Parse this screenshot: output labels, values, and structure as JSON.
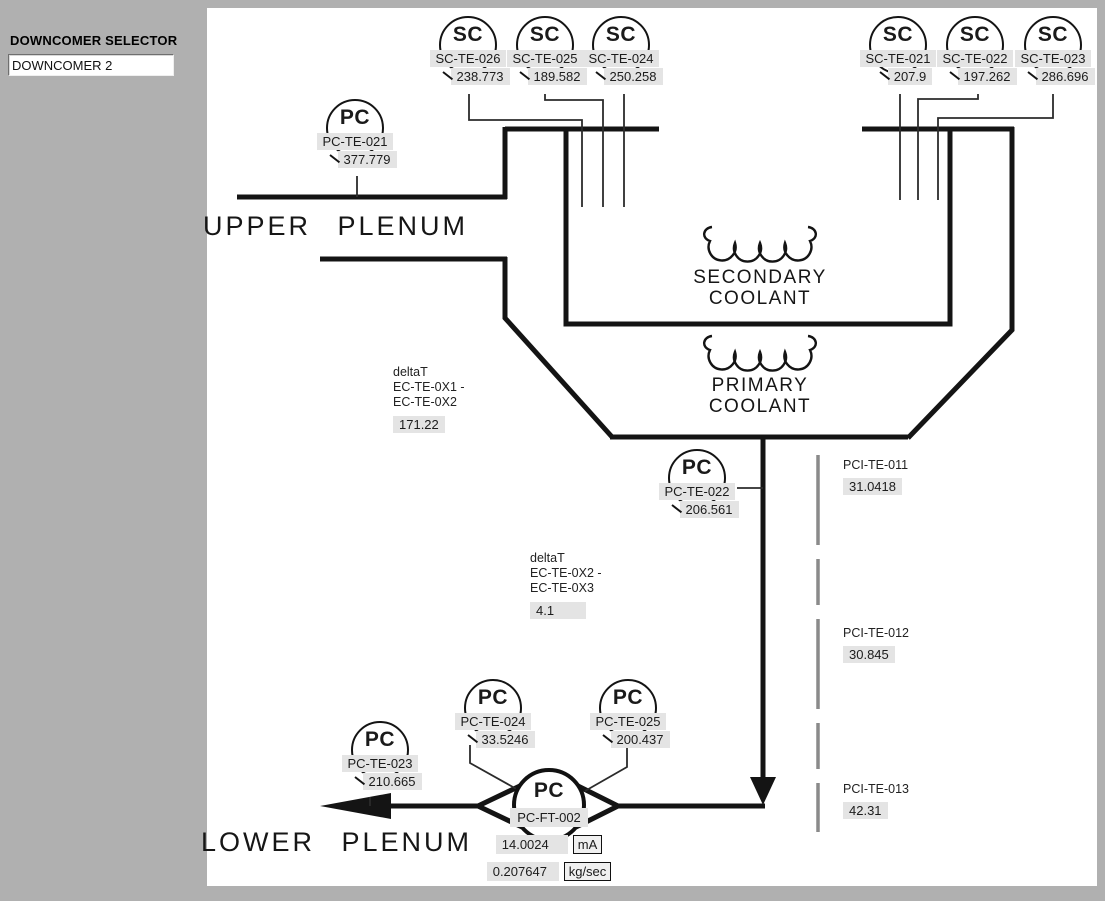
{
  "sidebar": {
    "selector_label": "DOWNCOMER SELECTOR",
    "selector_value": "DOWNCOMER 2"
  },
  "diagram": {
    "labels": {
      "upper_plenum": "UPPER PLENUM",
      "lower_plenum": "LOWER PLENUM",
      "secondary_coolant": "SECONDARY COOLANT",
      "primary_coolant": "PRIMARY COOLANT"
    },
    "instruments": [
      {
        "symbol": "PC",
        "tag": "PC-TE-021",
        "value": "377.779"
      },
      {
        "symbol": "SC",
        "tag": "SC-TE-026",
        "value": "238.773"
      },
      {
        "symbol": "SC",
        "tag": "SC-TE-025",
        "value": "189.582"
      },
      {
        "symbol": "SC",
        "tag": "SC-TE-024",
        "value": "250.258"
      },
      {
        "symbol": "SC",
        "tag": "SC-TE-021",
        "value": "207.9"
      },
      {
        "symbol": "SC",
        "tag": "SC-TE-022",
        "value": "197.262"
      },
      {
        "symbol": "SC",
        "tag": "SC-TE-023",
        "value": "286.696"
      },
      {
        "symbol": "PC",
        "tag": "PC-TE-022",
        "value": "206.561"
      },
      {
        "symbol": "PC",
        "tag": "PC-TE-024",
        "value": "33.5246"
      },
      {
        "symbol": "PC",
        "tag": "PC-TE-025",
        "value": "200.437"
      },
      {
        "symbol": "PC",
        "tag": "PC-TE-023",
        "value": "210.665"
      }
    ],
    "flow_meter": {
      "symbol": "PC",
      "tag": "PC-FT-002",
      "current_value": "14.0024",
      "current_unit": "mA",
      "flow_value": "0.207647",
      "flow_unit": "kg/sec"
    },
    "delta_t": [
      {
        "line1": "deltaT",
        "line2": "EC-TE-0X1 -",
        "line3": "EC-TE-0X2",
        "value": "171.22"
      },
      {
        "line1": "deltaT",
        "line2": "EC-TE-0X2 -",
        "line3": "EC-TE-0X3",
        "value": "4.1"
      }
    ],
    "pci_sensors": [
      {
        "tag": "PCI-TE-011",
        "value": "31.0418"
      },
      {
        "tag": "PCI-TE-012",
        "value": "30.845"
      },
      {
        "tag": "PCI-TE-013",
        "value": "42.31"
      }
    ]
  },
  "colors": {
    "line": "#141414",
    "box_bg": "#e4e4e4",
    "sidebar_bg": "#b0b0b0",
    "dashed_line": "#8a8a8a",
    "canvas_bg": "#ffffff"
  }
}
